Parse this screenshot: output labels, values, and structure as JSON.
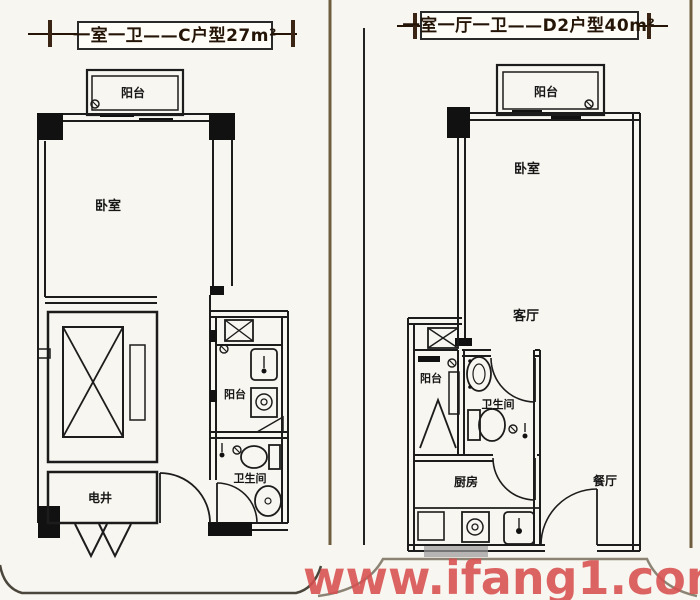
{
  "page": {
    "background_color": "#f8f6f0",
    "line_color": "#1c1c1c",
    "frame_brown_color": "#6f5d3f",
    "border_color": "#4a463c",
    "title_text_color": "#241507",
    "watermark": "www.ifang1.com",
    "watermark_color": "#d85050"
  },
  "left_plan": {
    "title": "一室一卫——C户型27m²",
    "labels": {
      "balcony": "阳台",
      "bedroom": "卧室",
      "service_balcony": "阳台",
      "electric_shaft": "电井",
      "bathroom": "卫生间"
    }
  },
  "right_plan": {
    "title": "一室一厅一卫——D2户型40m²",
    "labels": {
      "balcony": "阳台",
      "bedroom": "卧室",
      "living_room": "客厅",
      "service_balcony": "阳台",
      "bathroom": "卫生间",
      "kitchen": "厨房",
      "dining_room": "餐厅"
    }
  }
}
